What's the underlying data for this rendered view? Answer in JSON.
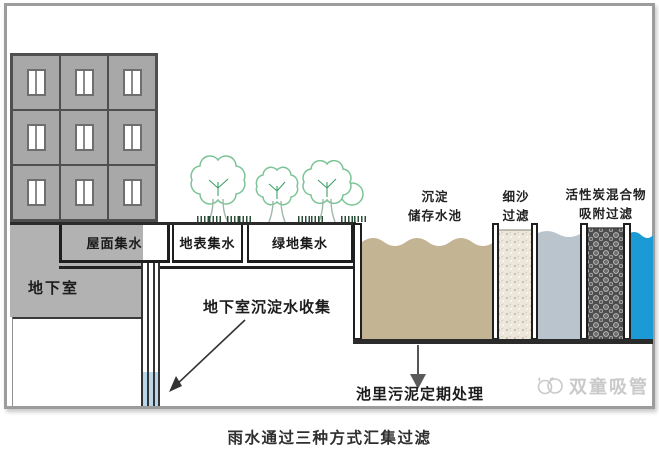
{
  "diagram": {
    "caption": "雨水通过三种方式汇集过滤",
    "labels": {
      "roof_collection": "屋面集水",
      "surface_collection": "地表集水",
      "green_collection": "绿地集水",
      "basement": "地下室",
      "basement_collect": "地下室沉淀水收集",
      "sediment_line1": "沉淀",
      "sediment_line2": "储存水池",
      "sand_line1": "细沙",
      "sand_line2": "过滤",
      "carbon_line1": "活性炭混合物",
      "carbon_line2": "吸附过滤",
      "sludge": "池里污泥定期处理"
    },
    "watermark": "双童吸管",
    "colors": {
      "tan_water": "#c3b493",
      "sand": "#ece7da",
      "gray_water": "#b9c4cd",
      "blue_water": "#1b9ad6",
      "pipe_water": "#b9d7e9",
      "building_gray": "#a8a8a8",
      "underground_gray": "#b2b2b2",
      "tree_green": "#7cc497",
      "carbon_dark": "#4d4d4d",
      "line_dark": "#2b2b2b",
      "watermark_gray": "#c9c9c9"
    }
  }
}
